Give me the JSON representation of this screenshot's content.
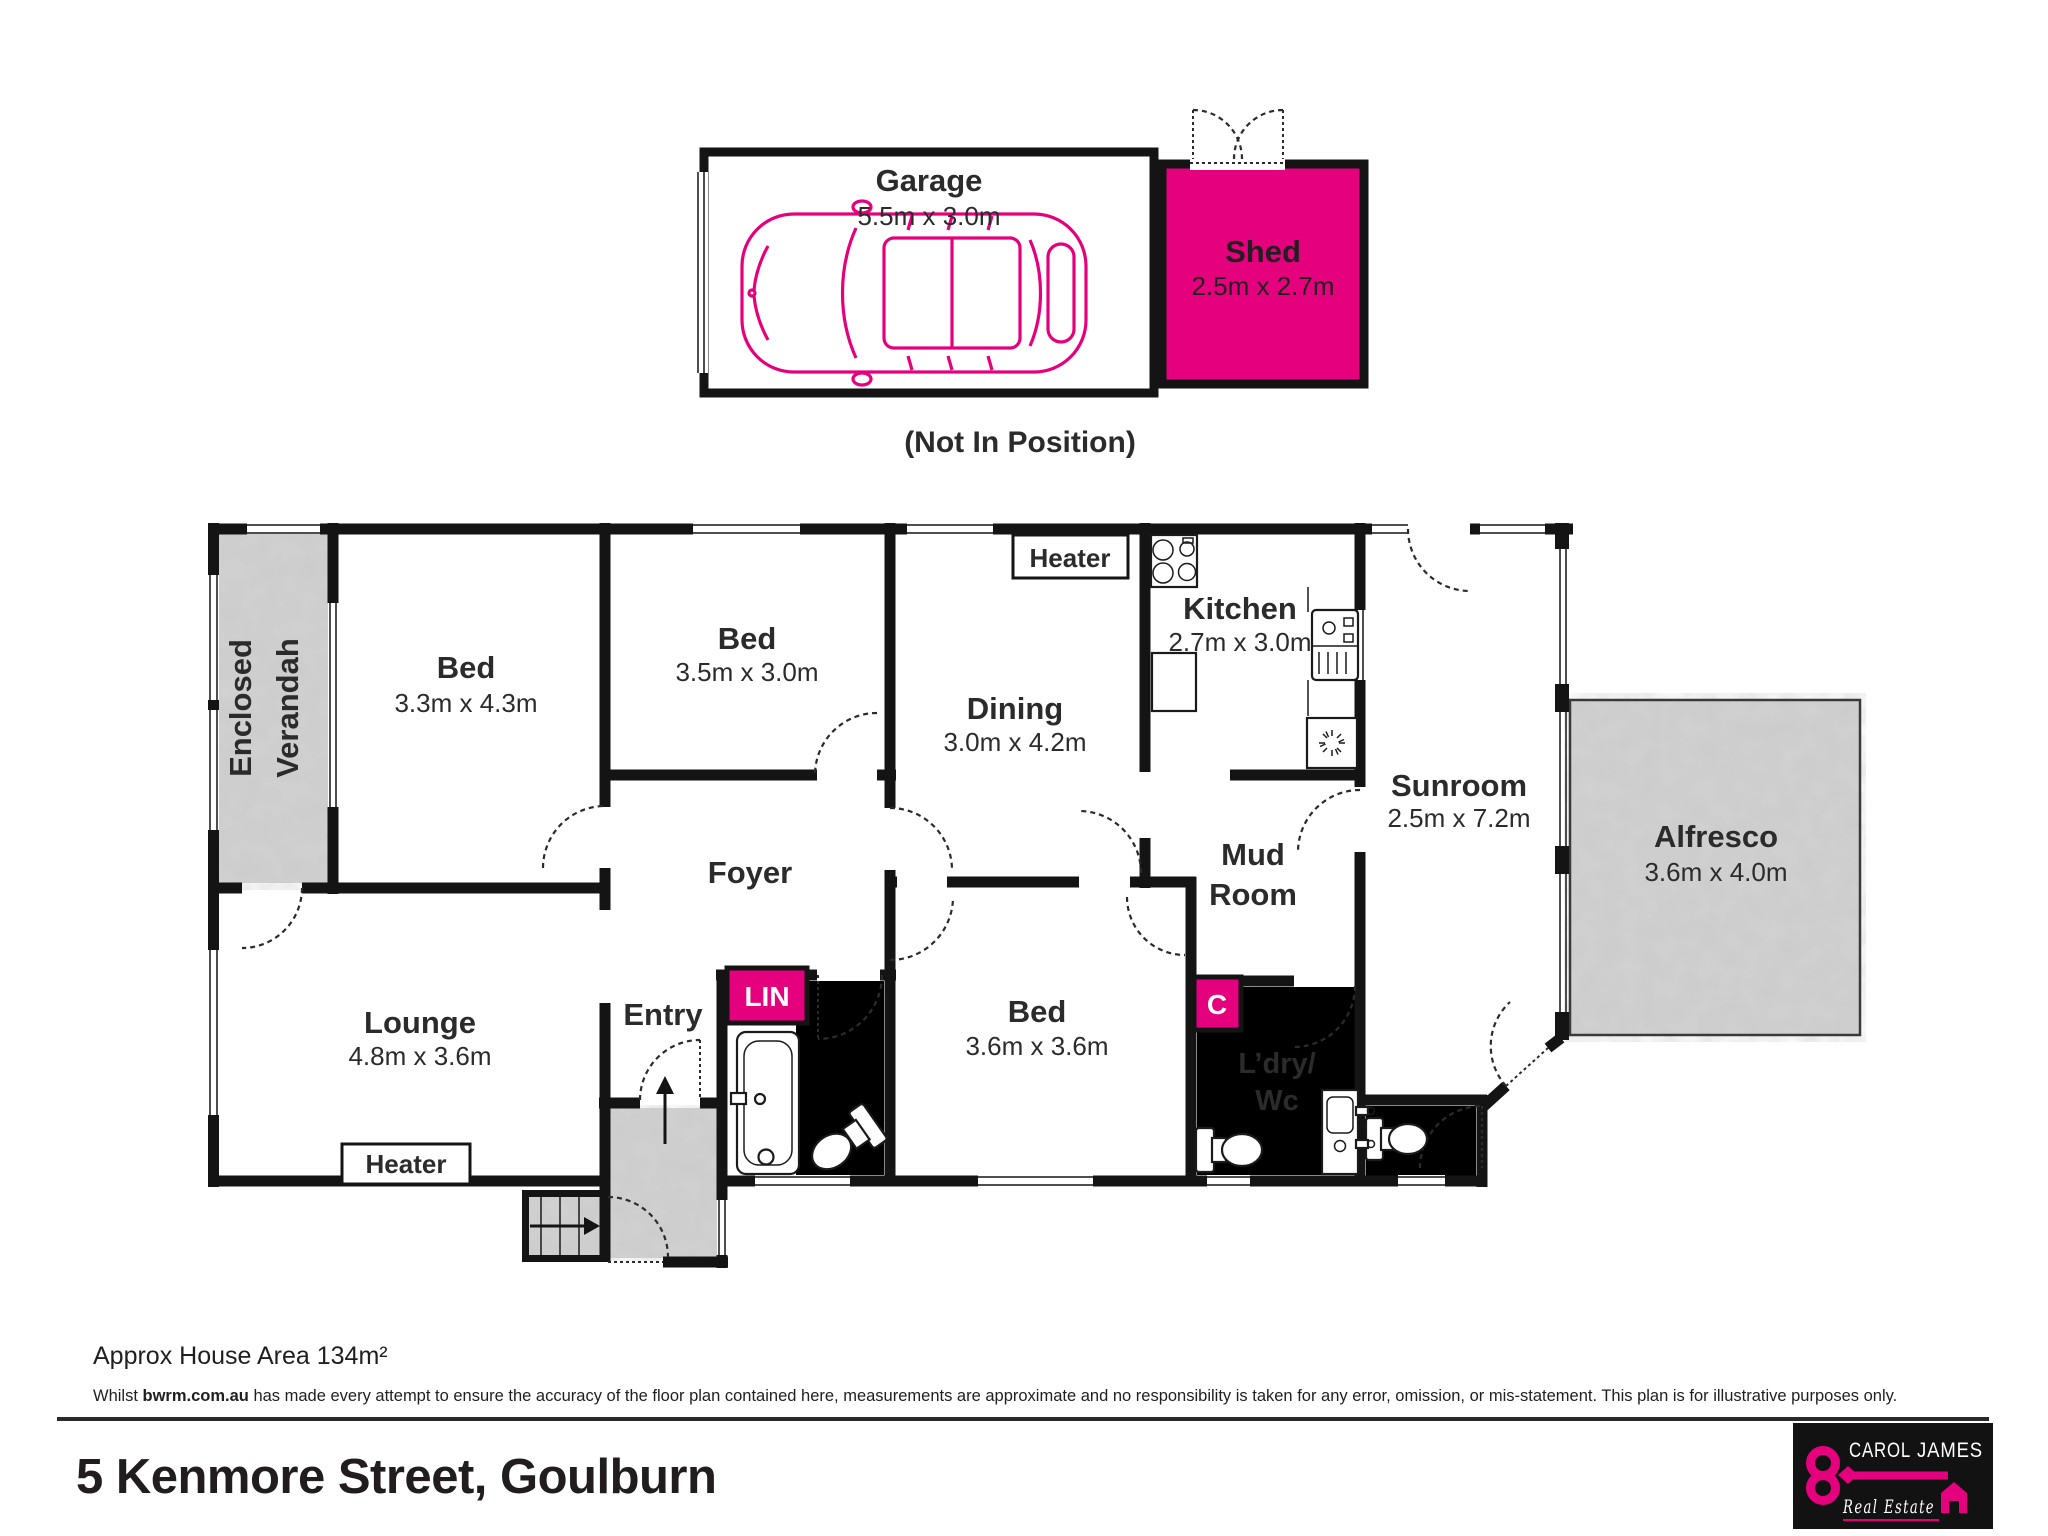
{
  "garage": {
    "name": "Garage",
    "dims": "5.5m x 3.0m"
  },
  "shed": {
    "name": "Shed",
    "dims": "2.5m x 2.7m"
  },
  "note_not_in_position": "(Not In Position)",
  "rooms": {
    "verandah": {
      "line1": "Enclosed",
      "line2": "Verandah"
    },
    "bed1": {
      "name": "Bed",
      "dims": "3.3m x 4.3m"
    },
    "bed2": {
      "name": "Bed",
      "dims": "3.5m x 3.0m"
    },
    "dining": {
      "name": "Dining",
      "dims": "3.0m x 4.2m"
    },
    "kitchen": {
      "name": "Kitchen",
      "dims": "2.7m x 3.0m"
    },
    "sunroom": {
      "name": "Sunroom",
      "dims": "2.5m x 7.2m"
    },
    "alfresco": {
      "name": "Alfresco",
      "dims": "3.6m x 4.0m"
    },
    "mudroom": {
      "line1": "Mud",
      "line2": "Room"
    },
    "foyer": {
      "name": "Foyer"
    },
    "lounge": {
      "name": "Lounge",
      "dims": "4.8m x 3.6m"
    },
    "entry": {
      "name": "Entry"
    },
    "bed3": {
      "name": "Bed",
      "dims": "3.6m x 3.6m"
    },
    "laundry": {
      "line1": "L’dry/",
      "line2": "Wc"
    },
    "linen": "LIN",
    "cupboard": "C",
    "heater": "Heater"
  },
  "icons": {
    "car": "car-top-view",
    "stove": "cooktop-four-burners",
    "kitchen_sink": "sink-with-drainer",
    "bathtub": "bathtub",
    "toilet": "toilet",
    "laundry_trough": "trough-with-taps",
    "stairs": "stairs-with-arrow",
    "up_arrow": "entry-direction-arrow"
  },
  "footer": {
    "area": "Approx House Area 134m²",
    "disclaimer_prefix": "Whilst ",
    "disclaimer_source": "bwrm.com.au",
    "disclaimer_rest": " has made every attempt to ensure the accuracy of the floor plan contained here, measurements are approximate and no responsibility is taken for any error, omission, or mis-statement. This plan is for illustrative purposes only.",
    "address": "5 Kenmore Street, Goulburn"
  },
  "logo": {
    "brand_first": "CAROL",
    "brand_second": "JAMES",
    "tagline": "Real Estate"
  },
  "colors": {
    "accent": "#e5007d",
    "wall": "#141414",
    "concrete": "#d2d2d2"
  }
}
